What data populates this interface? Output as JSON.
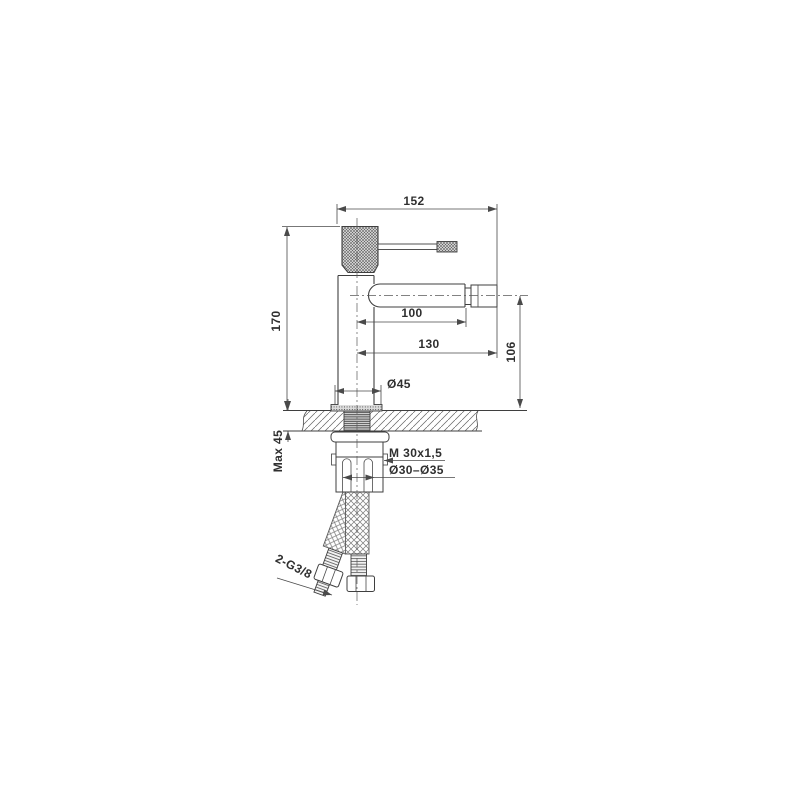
{
  "meta": {
    "type": "technical-drawing",
    "subject": "single-hole bidet/basin mixer faucet — side elevation with deck mounting section"
  },
  "colors": {
    "background": "#ffffff",
    "outline": "#3f3f3f",
    "dimension_lines": "#4a4a4a",
    "text": "#2f2f2f"
  },
  "labels": {
    "width_overall": "152",
    "height_overall": "170",
    "spout_reach": "100",
    "reach_overall": "130",
    "spout_height": "106",
    "base_diameter": "Ø45",
    "deck_thickness_max": "Max 45",
    "mounting_thread": "M 30x1,5",
    "hole_diameter_range": "Ø30–Ø35",
    "supply_connections": "2-G3/8"
  }
}
